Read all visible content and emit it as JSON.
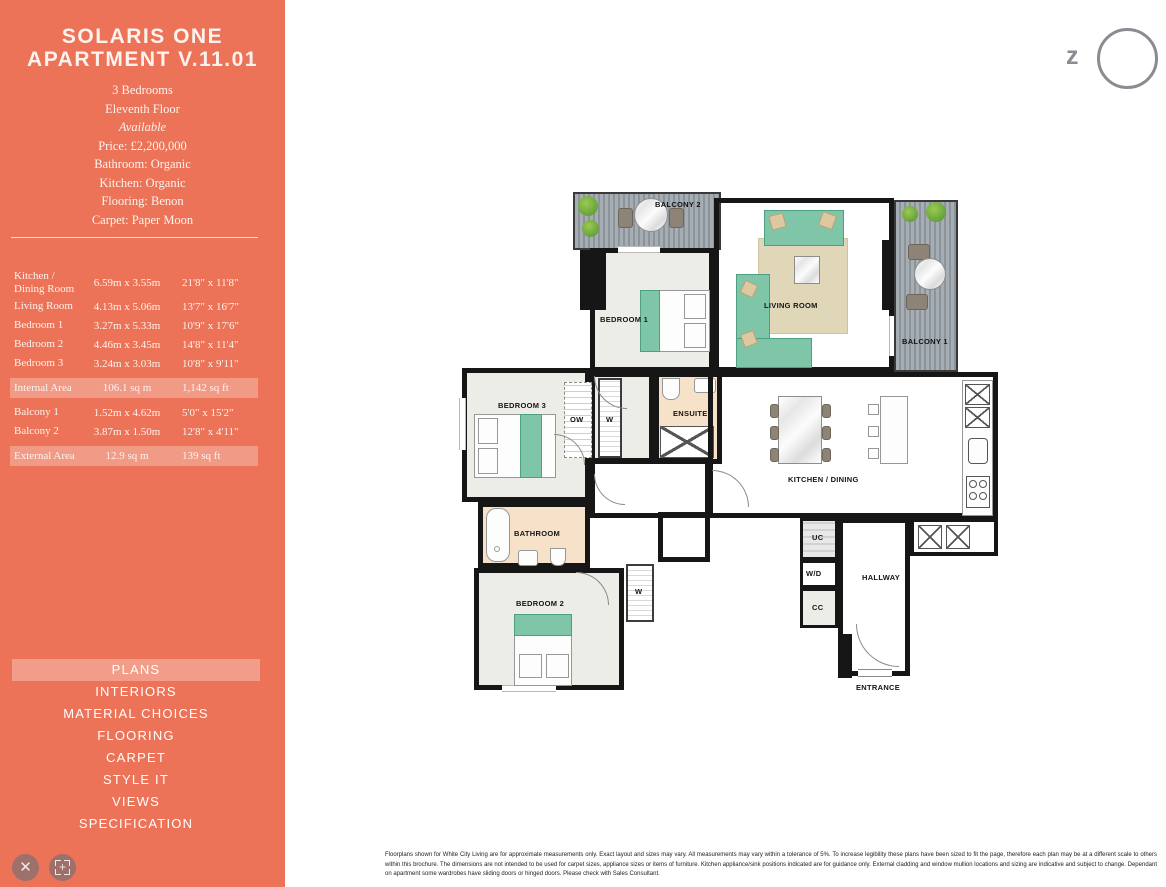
{
  "sidebar": {
    "title_line1": "SOLARIS ONE",
    "title_line2": "APARTMENT V.11.01",
    "details": [
      "3 Bedrooms",
      "Eleventh Floor",
      "Available",
      "Price: £2,200,000",
      "Bathroom: Organic",
      "Kitchen: Organic",
      "Flooring: Benon",
      "Carpet: Paper Moon"
    ],
    "rooms": [
      {
        "name": "Kitchen / Dining Room",
        "metric": "6.59m x 3.55m",
        "imperial": "21'8\" x 11'8\""
      },
      {
        "name": "Living Room",
        "metric": "4.13m x 5.06m",
        "imperial": "13'7\" x 16'7\""
      },
      {
        "name": "Bedroom 1",
        "metric": "3.27m x 5.33m",
        "imperial": "10'9\" x 17'6\""
      },
      {
        "name": "Bedroom 2",
        "metric": "4.46m x 3.45m",
        "imperial": "14'8\" x 11'4\""
      },
      {
        "name": "Bedroom 3",
        "metric": "3.24m x 3.03m",
        "imperial": "10'8\" x 9'11\""
      },
      {
        "name": "Internal Area",
        "metric": "106.1 sq m",
        "imperial": "1,142 sq ft"
      },
      {
        "name": "Balcony 1",
        "metric": "1.52m x 4.62m",
        "imperial": "5'0\" x 15'2\""
      },
      {
        "name": "Balcony 2",
        "metric": "3.87m x 1.50m",
        "imperial": "12'8\" x 4'11\""
      },
      {
        "name": "External Area",
        "metric": "12.9 sq m",
        "imperial": "139 sq ft"
      }
    ],
    "nav": [
      {
        "label": "PLANS",
        "active": true
      },
      {
        "label": "INTERIORS",
        "active": false
      },
      {
        "label": "MATERIAL CHOICES",
        "active": false
      },
      {
        "label": "FLOORING",
        "active": false
      },
      {
        "label": "CARPET",
        "active": false
      },
      {
        "label": "STYLE IT",
        "active": false
      },
      {
        "label": "VIEWS",
        "active": false
      },
      {
        "label": "SPECIFICATION",
        "active": false
      }
    ]
  },
  "controls": {
    "close_glyph": "✕",
    "expand_glyph": "+"
  },
  "logo": {
    "letter": "z"
  },
  "plan": {
    "labels": {
      "balcony2": "BALCONY 2",
      "bedroom1": "BEDROOM 1",
      "living_room": "LIVING ROOM",
      "balcony1": "BALCONY 1",
      "bedroom3": "BEDROOM 3",
      "ow": "OW",
      "w_top": "W",
      "ensuite": "ENSUITE",
      "kitchen_dining": "KITCHEN / DINING",
      "bathroom": "BATHROOM",
      "bedroom2": "BEDROOM 2",
      "w_bottom": "W",
      "uc": "UC",
      "wd": "W/D",
      "cc": "CC",
      "hallway": "HALLWAY",
      "entrance": "ENTRANCE"
    }
  },
  "colors": {
    "accent": "#EC7357",
    "wall": "#161616",
    "wood": "#AC9171",
    "deck": "#99A1A8",
    "furniture_teal": "#7EC6A7",
    "tile": "#F5E2C8"
  },
  "footer": {
    "disclaimer": "Floorplans shown for White City Living are for approximate measurements only. Exact layout and sizes may vary. All measurements may vary within a tolerance of 5%. To increase legibility these plans have been sized to fit the page, therefore each plan may be at a different scale to others within this brochure. The dimensions are not intended to be used for carpet sizes, appliance sizes or items of furniture. Kitchen appliance/sink positions indicated are for guidance only. External cladding and window mullion locations and sizing are indicative and subject to change. Dependant on apartment some wardrobes have sliding doors or hinged doors. Please check with Sales Consultant."
  }
}
